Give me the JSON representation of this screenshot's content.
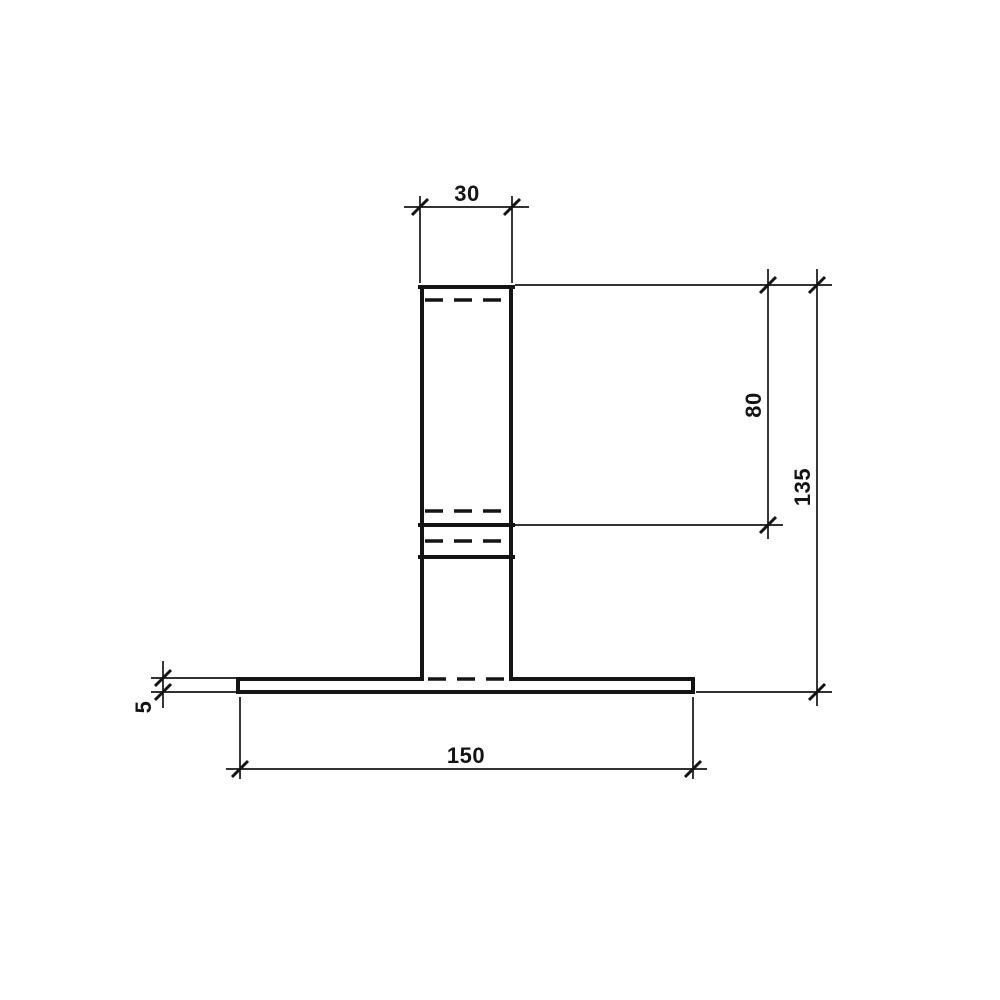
{
  "drawing": {
    "type": "technical-elevation-drawing",
    "background": "#ffffff",
    "line_color": "#141414",
    "dimension_labels": {
      "column_width": "30",
      "upper_height": "80",
      "total_height": "135",
      "base_thickness": "5",
      "base_width": "150"
    }
  }
}
